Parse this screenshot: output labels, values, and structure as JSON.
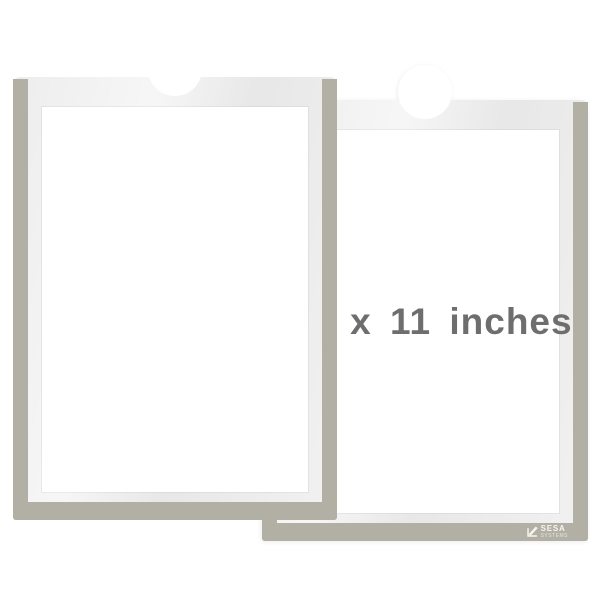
{
  "product": {
    "size_label": "8.5 x 11 inches",
    "brand": {
      "name": "SESA",
      "subname": "SYSTEMS"
    }
  },
  "scene": {
    "back_holder": "blank document pocket with grey frame and thumb notch",
    "front_holder": "document pocket with grey frame, thumb notch, size label and brand logo",
    "icons": [
      "sesa-pencil-check-icon"
    ]
  },
  "colors": {
    "frame_gray": "#b2b0a5",
    "pocket_gray": "#ececec",
    "paper_white": "#ffffff",
    "label_text": "#6e6e6e",
    "logo_white": "#f6f5f0",
    "background": "#ffffff"
  }
}
